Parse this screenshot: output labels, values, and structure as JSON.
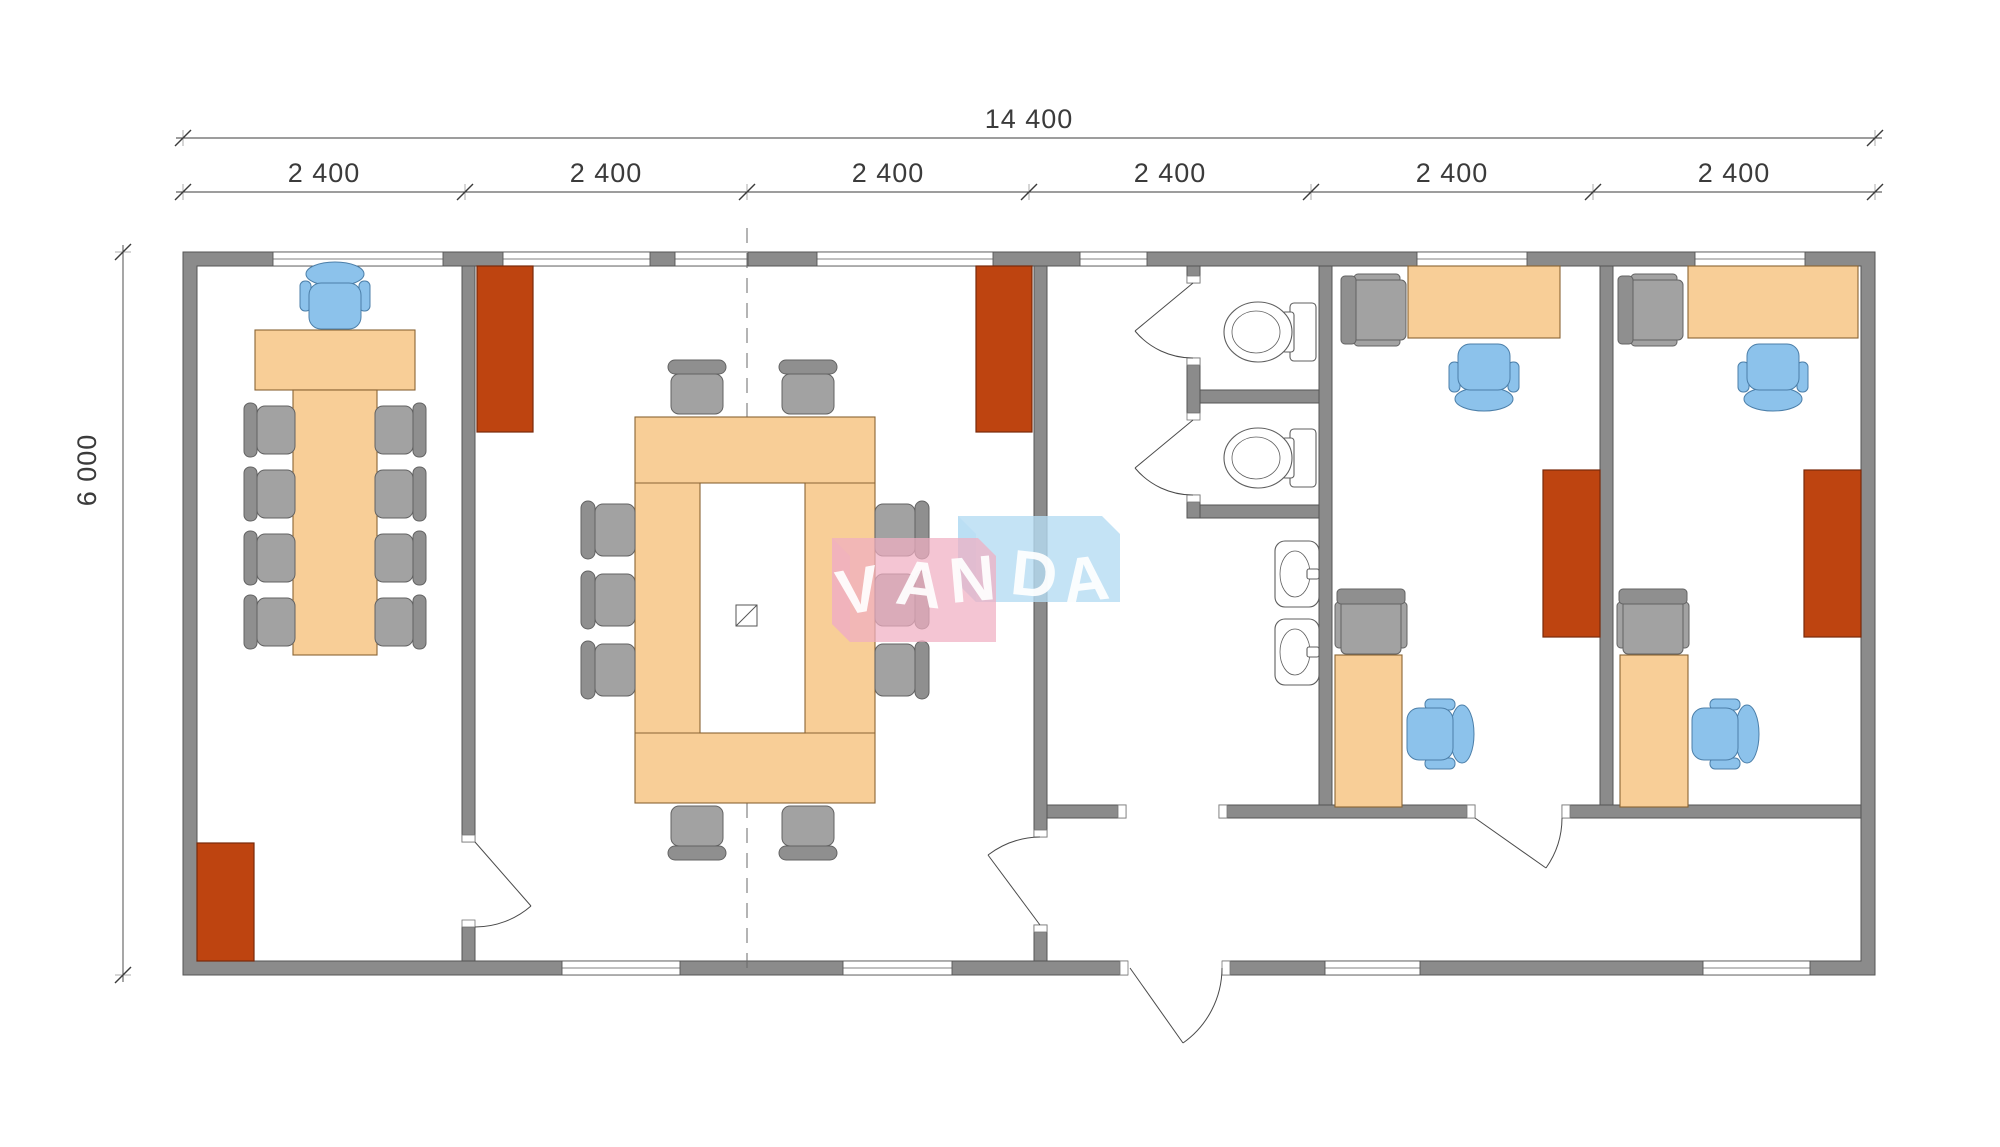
{
  "watermark": {
    "text": "VANDA",
    "letters": [
      "V",
      "A",
      "N",
      "D",
      "A"
    ]
  },
  "dimensions": {
    "total_width_label": "14 400",
    "module_labels": [
      "2 400",
      "2 400",
      "2 400",
      "2 400",
      "2 400",
      "2 400"
    ],
    "height_label": "6 000"
  },
  "colors": {
    "wall_fill": "#8B8B8B",
    "wall_edge": "#565656",
    "desk_fill": "#F8CE97",
    "desk_edge": "#8A6434",
    "wardrobe_fill": "#BE4410",
    "wardrobe_edge": "#79290A",
    "gray_chair": "#A2A2A2",
    "gray_chair_back": "#8F8F8F",
    "gray_chair_edge": "#636363",
    "blue_chair": "#8CC2EB",
    "blue_chair_edge": "#4C7FA9",
    "fixture_edge": "#5F5F5F",
    "dim_color": "#3B3B3B",
    "wm_blue": "#B5DCF2",
    "wm_pink": "#F0AFC2"
  },
  "inventory": {
    "modules_across": 6,
    "meeting_room_left": {
      "t_shaped_desk": 1,
      "gray_chairs": 8,
      "blue_executive_chair": 1,
      "red_wardrobes": 1
    },
    "conference_room": {
      "ring_table": 1,
      "gray_chairs": 10,
      "red_wardrobes": 2,
      "doors": 2,
      "center_hatch_symbol": 1
    },
    "sanitary_hall": {
      "wc_stalls": 2,
      "toilets": 2,
      "washbasins": 2
    },
    "office_a": {
      "desks": 2,
      "blue_chairs": 2,
      "gray_armchairs": 2,
      "red_wardrobes": 1,
      "doors": 1
    },
    "office_b": {
      "desks": 2,
      "blue_chairs": 2,
      "gray_armchairs": 2,
      "red_wardrobes": 1
    },
    "corridor": {
      "entrance_doors": 1,
      "passage_openings": 1
    }
  }
}
